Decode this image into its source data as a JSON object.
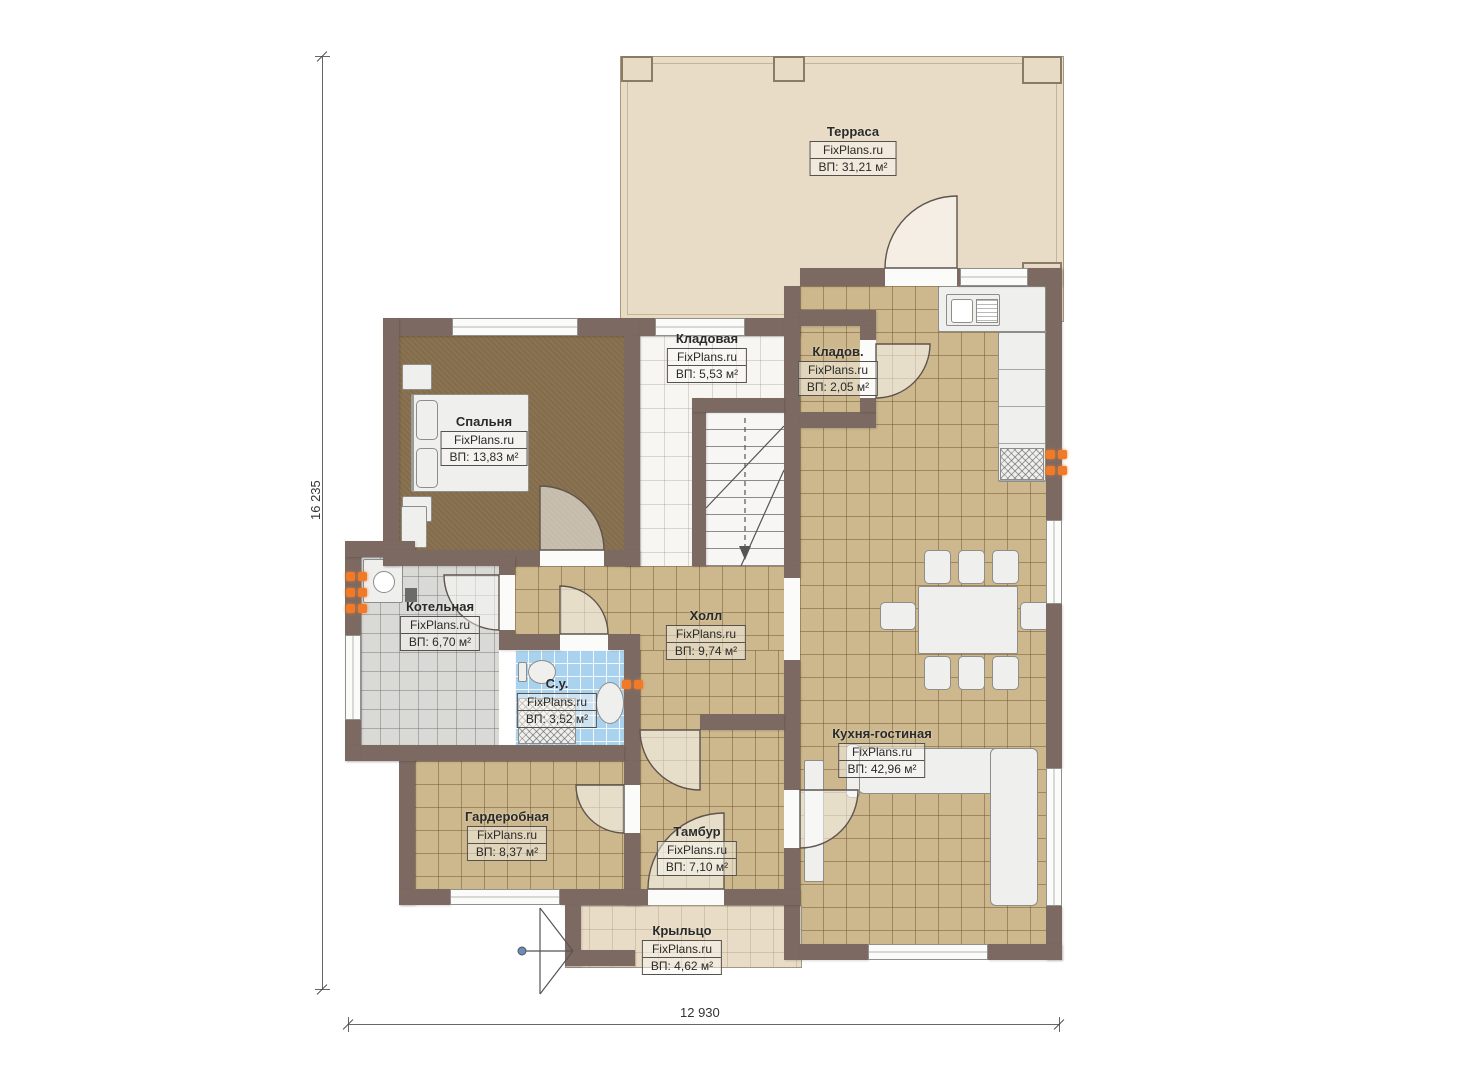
{
  "plan": {
    "watermark": "FixPlans.ru",
    "dimensions": {
      "height_label": "16 235",
      "width_label": "12 930"
    },
    "rooms": [
      {
        "id": "terrace",
        "name": "Терраса",
        "area": "ВП: 31,21 м²"
      },
      {
        "id": "storage",
        "name": "Кладовая",
        "area": "ВП: 5,53 м²"
      },
      {
        "id": "storage2",
        "name": "Кладов.",
        "area": "ВП: 2,05 м²"
      },
      {
        "id": "bedroom",
        "name": "Спальня",
        "area": "ВП: 13,83 м²"
      },
      {
        "id": "boiler",
        "name": "Котельная",
        "area": "ВП: 6,70 м²"
      },
      {
        "id": "hall",
        "name": "Холл",
        "area": "ВП: 9,74 м²"
      },
      {
        "id": "bathroom",
        "name": "С.у.",
        "area": "ВП: 3,52 м²"
      },
      {
        "id": "kitchen",
        "name": "Кухня-гостиная",
        "area": "ВП: 42,96 м²"
      },
      {
        "id": "wardrobe",
        "name": "Гардеробная",
        "area": "ВП: 8,37 м²"
      },
      {
        "id": "vestibule",
        "name": "Тамбур",
        "area": "ВП: 7,10 м²"
      },
      {
        "id": "porch",
        "name": "Крыльцо",
        "area": "ВП: 4,62 м²"
      }
    ],
    "colors": {
      "wall": "#7c6a62",
      "terrace_floor": "#e9dcc7",
      "tile_floor": "#cdb88e",
      "carpet_floor": "#8a7351",
      "gray_tile": "#d9d9d6",
      "blue_tile": "#a9d2ef",
      "white_floor": "#f7f6f3",
      "furniture": "#efefed",
      "accent_radiator": "#f07a28"
    }
  }
}
